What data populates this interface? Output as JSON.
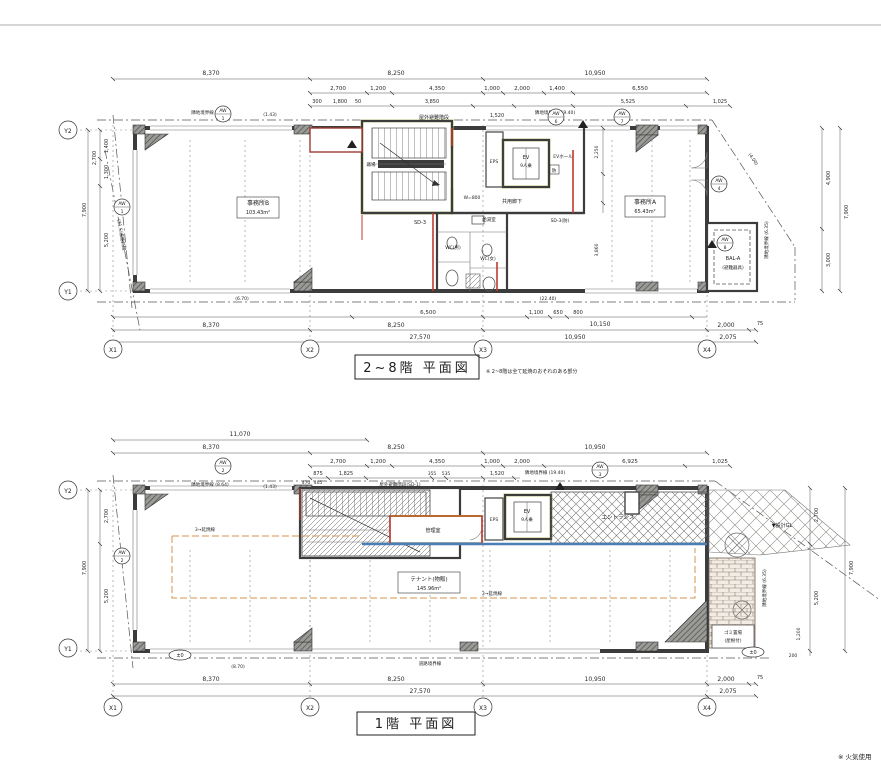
{
  "common": {
    "axis_x": [
      "X1",
      "X2",
      "X3",
      "X4"
    ],
    "axis_y": [
      "Y1",
      "Y2"
    ],
    "aw": "AW",
    "pm0": "±0",
    "fire_note": "※  火気使用"
  },
  "top": {
    "title": "2~8階 平面図",
    "note": "※ 2~8階は全て延焼のおそれのある部分",
    "rooms": {
      "officeB": "事務所B",
      "officeB_area": "103.43m²",
      "officeA": "事務所A",
      "officeA_area": "65.43m²",
      "ev": "EV",
      "ev_cap": "9人乗",
      "ev_hall": "EVホール",
      "eps": "EPS",
      "corridor": "共用廊下",
      "stair": "屋外避難階段",
      "landing": "踊場",
      "kitchen": "給湯室",
      "wc_m": "WC(男)",
      "wc_w": "WC(女)",
      "bal": "BAL-A",
      "hinan": "(避難器具)",
      "bofu": "防",
      "sd3": "SD-3",
      "sd3b": "SD-3(防)",
      "w800": "W=800"
    },
    "boundary": {
      "top_l": "隣地境界線 (8.64)",
      "top_r": "隣地境界線 (19.40)",
      "right": "隣地境界線 (6.35)",
      "slant": "(31.5)道路斜線",
      "d143": "(1.43)",
      "d400": "(4.00)",
      "d2240": "(22.40)",
      "d670": "(6.70)"
    },
    "dims": {
      "r1": [
        "8,370",
        "8,250",
        "10,950"
      ],
      "r2": [
        "2,700",
        "1,200",
        "4,350",
        "1,000",
        "2,000",
        "1,400",
        "6,550"
      ],
      "r3": [
        "300",
        "1,800",
        "50",
        "3,850",
        "1,520",
        "5,525",
        "1,025"
      ],
      "left": [
        "1,400",
        "1,300",
        "2,700",
        "5,200",
        "7,900"
      ],
      "right": [
        "4,900",
        "3,000",
        "7,900",
        "2,250",
        "3,860"
      ],
      "b1": [
        "6,500",
        "1,100",
        "650",
        "800",
        "10,150"
      ],
      "b2": [
        "8,370",
        "8,250",
        "10,950",
        "2,000",
        "75"
      ],
      "b3": [
        "27,570",
        "2,075"
      ]
    },
    "aw_marks": [
      "1",
      "1",
      "6",
      "7",
      "4",
      "8"
    ]
  },
  "bottom": {
    "title": "1階 平面図",
    "rooms": {
      "kanri": "管理室",
      "tenant": "テナント(物販)",
      "tenant_area": "145.96m²",
      "entrance": "エントランス",
      "ev": "EV",
      "ev_cap": "9人乗",
      "eps": "EPS",
      "gomi": "ゴミ置場",
      "gomi2": "(屋根付)",
      "stair": "屋外避難階段(SD-1)",
      "enshou": "3→延焼線",
      "gl": "▼設計GL",
      "road": "道路境界線"
    },
    "boundary": {
      "top_l": "隣地境界線 (8.64)",
      "top_r": "隣地境界線 (19.40)",
      "right": "隣地境界線 (6.35)",
      "d143": "(1.43)",
      "d870": "(8.70)"
    },
    "dims": {
      "r0": "11,070",
      "r1": [
        "8,370",
        "8,250",
        "10,950"
      ],
      "r2": [
        "2,700",
        "1,200",
        "4,350",
        "1,000",
        "2,000",
        "6,925",
        "1,025"
      ],
      "r3": [
        "875",
        "1,825",
        "470",
        "405",
        "355",
        "535",
        "1,520"
      ],
      "left": [
        "2,700",
        "5,200",
        "7,900"
      ],
      "right": [
        "2,700",
        "7,900",
        "5,200",
        "1,200",
        "200"
      ],
      "b1": [
        "8,370",
        "8,250",
        "10,950",
        "2,000",
        "75"
      ],
      "b2": [
        "27,570",
        "2,075"
      ]
    },
    "aw_marks": [
      "2",
      "2",
      "3"
    ]
  }
}
